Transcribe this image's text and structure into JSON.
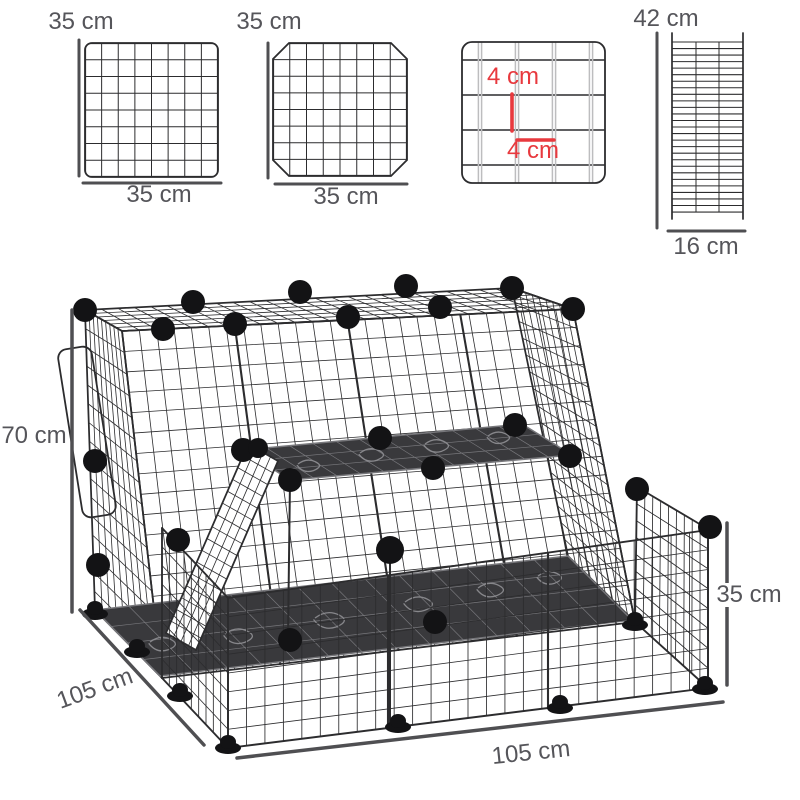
{
  "colors": {
    "dimension_red": "#e8393e",
    "dimension_gray": "#55555a",
    "line_gray": "#4f4f52",
    "wire_dark": "#2c2c2e",
    "wire_light": "#bdbdbf",
    "mat_dark": "#39393c",
    "swirl_light": "#8b8b8f",
    "connector_black": "#131315"
  },
  "panels": {
    "square_panel": {
      "height_label": "35 cm",
      "width_label": "35 cm"
    },
    "door_panel": {
      "height_label": "35 cm",
      "width_label": "35 cm"
    },
    "mesh_detail_panel": {
      "cell_height_label": "4 cm",
      "cell_width_label": "4 cm"
    },
    "ramp_panel": {
      "height_label": "42 cm",
      "width_label": "16 cm"
    }
  },
  "cage": {
    "height_label": "70 cm",
    "side_depth_label": "105 cm",
    "front_width_label": "105 cm",
    "fence_height_label": "35 cm"
  }
}
